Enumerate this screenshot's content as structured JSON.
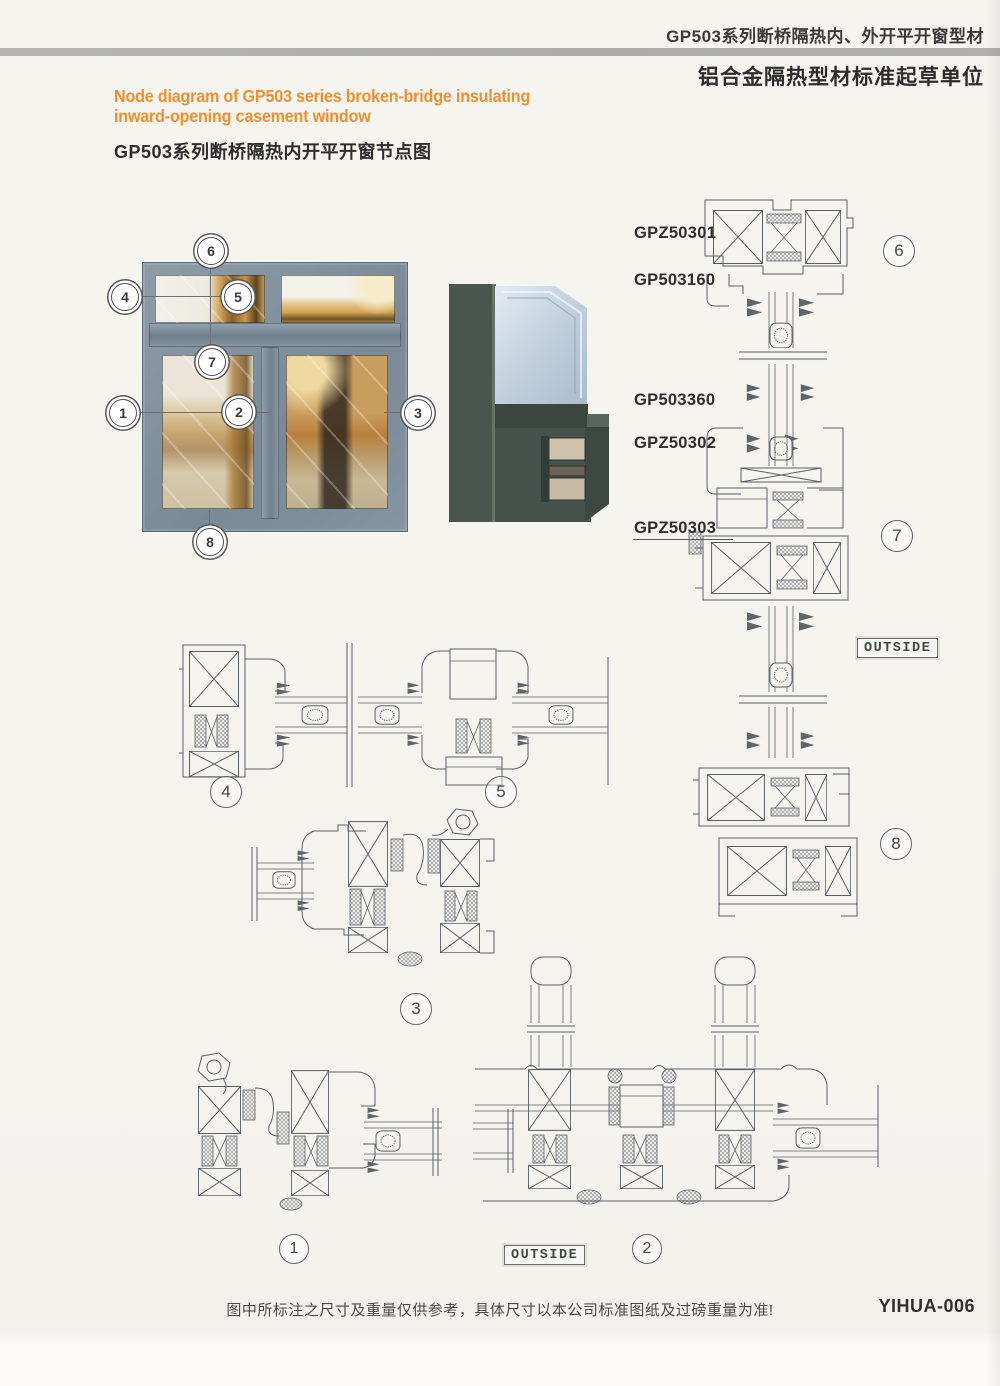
{
  "header": {
    "product_line": "GP503系列断桥隔热内、外开平开窗型材",
    "org_line": "铝合金隔热型材标准起草单位"
  },
  "title": {
    "en_line1": "Node diagram of GP503 series broken-bridge insulating",
    "en_line2": "inward-opening casement window",
    "zh": "GP503系列断桥隔热内开平开窗节点图"
  },
  "photo": {
    "callouts": [
      "1",
      "2",
      "3",
      "4",
      "5",
      "6",
      "7",
      "8"
    ]
  },
  "right_assembly": {
    "labels": [
      "GPZ50301",
      "GP503160",
      "GP503360",
      "GPZ50302",
      "GPZ50303"
    ],
    "markers": [
      "6",
      "7",
      "8"
    ],
    "outside_label": "OUTSIDE"
  },
  "detail_markers": {
    "s1": "1",
    "s2": "2",
    "s3": "3",
    "s4": "4",
    "s5": "5"
  },
  "outside_label_bottom": "OUTSIDE",
  "footer": {
    "note": "图中所标注之尺寸及重量仅供参考，具体尺寸以本公司标准图纸及过磅重量为准!",
    "code": "YIHUA-006"
  },
  "colors": {
    "accent_orange": "#ee8f30",
    "frame_gray": "#82929e",
    "cad_line": "#5a5f66",
    "divider_bar": "#b2b1ad"
  }
}
